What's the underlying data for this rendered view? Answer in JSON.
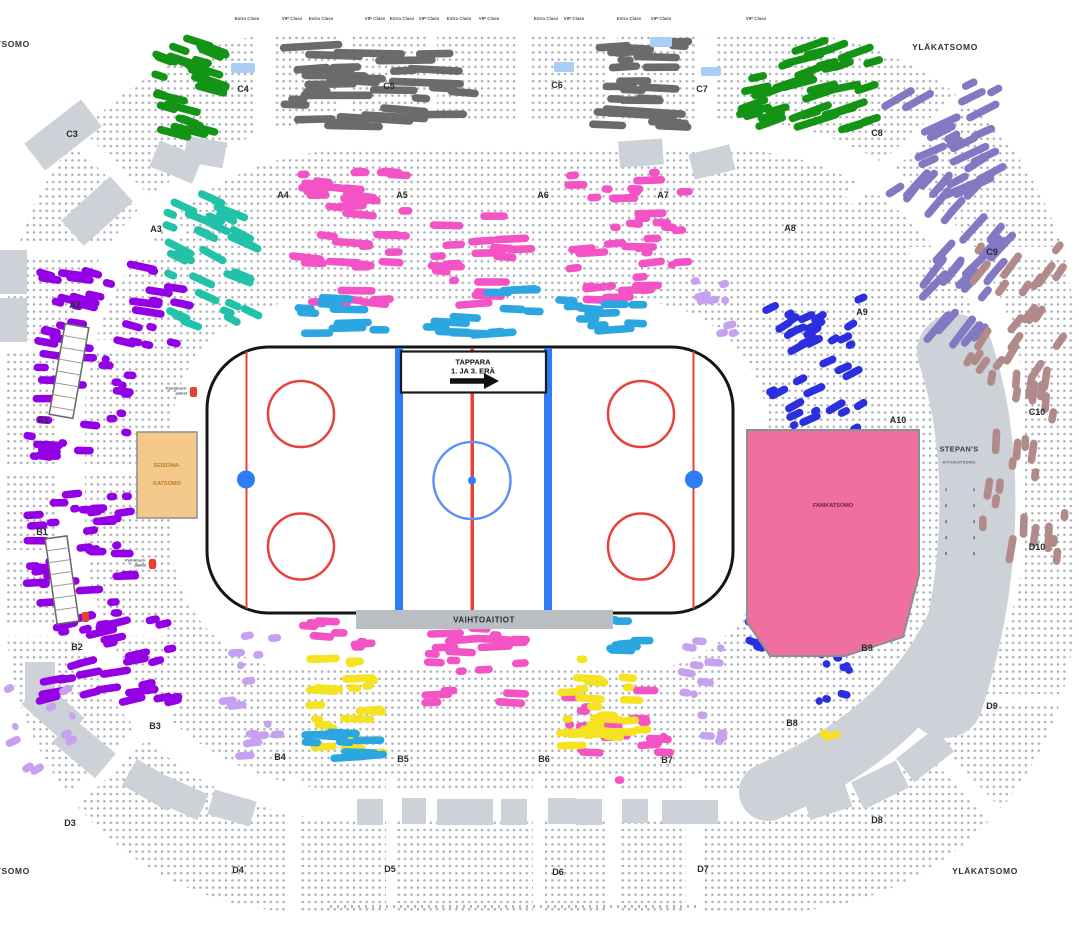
{
  "arena": {
    "upper_tier_label": "YLÄKATSOMO",
    "rink": {
      "team": "TAPPARA",
      "period_note": "1. JA 3. ERÄ",
      "benches": "VAIHTOAITIOT"
    },
    "zones": {
      "standing_line1": "SEISOMA-",
      "standing_line2": "KATSOMO",
      "fan_zone": "FANIKATSOMO",
      "stepans_title": "STEPAN'S",
      "stepans_subtitle": "AITIOKATSOMO",
      "stepans_col_a": [
        "1",
        "2",
        "3",
        "4",
        "5"
      ],
      "stepans_col_b": [
        "1",
        "2",
        "3",
        "4",
        "5"
      ]
    },
    "sections": [
      "C3",
      "C4",
      "C5",
      "C6",
      "C7",
      "C8",
      "C9",
      "C10",
      "D3",
      "D4",
      "D5",
      "D6",
      "D7",
      "D8",
      "D9",
      "D10",
      "A1",
      "A2",
      "A3",
      "A4",
      "A5",
      "A6",
      "A7",
      "A8",
      "A9",
      "A10",
      "B1",
      "B2",
      "B3",
      "B4",
      "B5",
      "B6",
      "B7",
      "B8",
      "B9"
    ],
    "suite_labels": [
      {
        "a": "Extra Class",
        "b": "Terrace"
      },
      {
        "a": "Extra Class",
        "b": "Terrace"
      },
      {
        "a": "VIP Class",
        "b": "Terrace"
      },
      {
        "a": "Extra Class",
        "b": "Terrace"
      },
      {
        "a": "VIP Class",
        "b": "Terrace"
      },
      {
        "a": "Extra Class",
        "b": "Terrace"
      },
      {
        "a": "VIP Class",
        "b": "Terrace"
      },
      {
        "a": "Extra Class",
        "b": "Terrace"
      },
      {
        "a": "VIP Class",
        "b": "Terrace"
      },
      {
        "a": "Extra Class",
        "b": "Terrace"
      },
      {
        "a": "VIP Class",
        "b": "Terrace"
      },
      {
        "a": "Extra Class",
        "b": "Terrace"
      },
      {
        "a": "VIP Class",
        "b": "Terrace"
      },
      {
        "a": "VIP Class",
        "b": "Terrace"
      }
    ],
    "accessible_note_line1": "Pyörätuoli-",
    "accessible_note_line2": "paikat",
    "colors": {
      "green": "#149414",
      "teal": "#21c2a8",
      "pink": "#f353c4",
      "cyan": "#2ba6e0",
      "purple": "#9400e6",
      "lavender": "#c6a1f0",
      "slate": "#8279c2",
      "rosy": "#b18a8a",
      "blue": "#2b2fe0",
      "yellow": "#f5e321",
      "sold": "#6b6b6b",
      "fan_zone_pink": "#ef6f9f",
      "standing_zone_tan": "#f5c98c",
      "wheelchair_blue": "#a9cdf4",
      "marker_red": "#e8402a",
      "structure_gray": "#ccd2d7",
      "rink_red": "#e8413a",
      "rink_blue": "#2f7df6"
    }
  }
}
